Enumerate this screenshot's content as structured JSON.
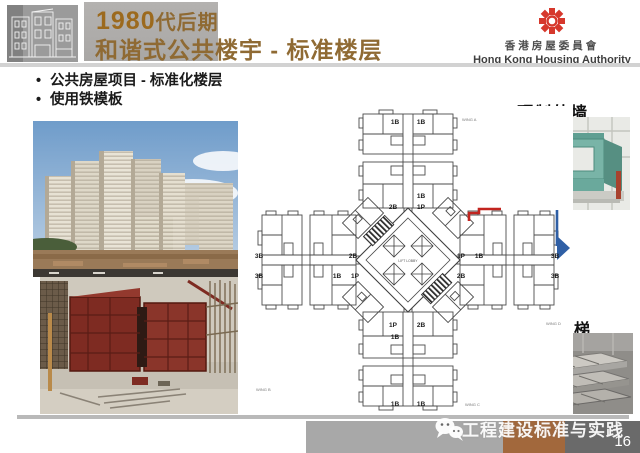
{
  "header": {
    "title_year": "1980",
    "title_line1_rest": "代后期",
    "title_line2": "和谐式公共楼宇 - 标准楼层",
    "authority_zh": "香港房屋委員會",
    "authority_en": "Hong Kong Housing Authority",
    "logo_color": "#d6382c"
  },
  "bullets": {
    "dot": "•",
    "item1": "公共房屋项目 - 标准化楼层",
    "item2": "使用铁模板"
  },
  "captions": {
    "precast_slab": "预制叠合板",
    "precast_facade": "预制外墙",
    "precast_stair": "预制楼梯",
    "integrated_steel_formwork": "整合式铁板模"
  },
  "floor_plan": {
    "core_label": "LIFT LOBBY",
    "wing_a": "WING A",
    "wing_b": "WING B",
    "wing_c": "WING C",
    "wing_d": "WING D",
    "units": [
      "1B",
      "1B",
      "1B",
      "2B",
      "1P",
      "3B",
      "2B",
      "3B",
      "1B",
      "1P",
      "1P",
      "1B",
      "3B",
      "2B",
      "3B",
      "1P",
      "2B",
      "1B",
      "1B",
      "1B"
    ],
    "highlight_colors": {
      "precast_facade_wall": "#c2241f",
      "marker_arrow": "#2f5fa5"
    }
  },
  "footer": {
    "watermark": "工程建设标准与实践",
    "page": "16"
  },
  "colors": {
    "title_brown": "#8f6a33",
    "bar_gray": "#a8a8a8",
    "bar_brown": "#a2683c",
    "bar_dark": "#6a6a6a"
  }
}
